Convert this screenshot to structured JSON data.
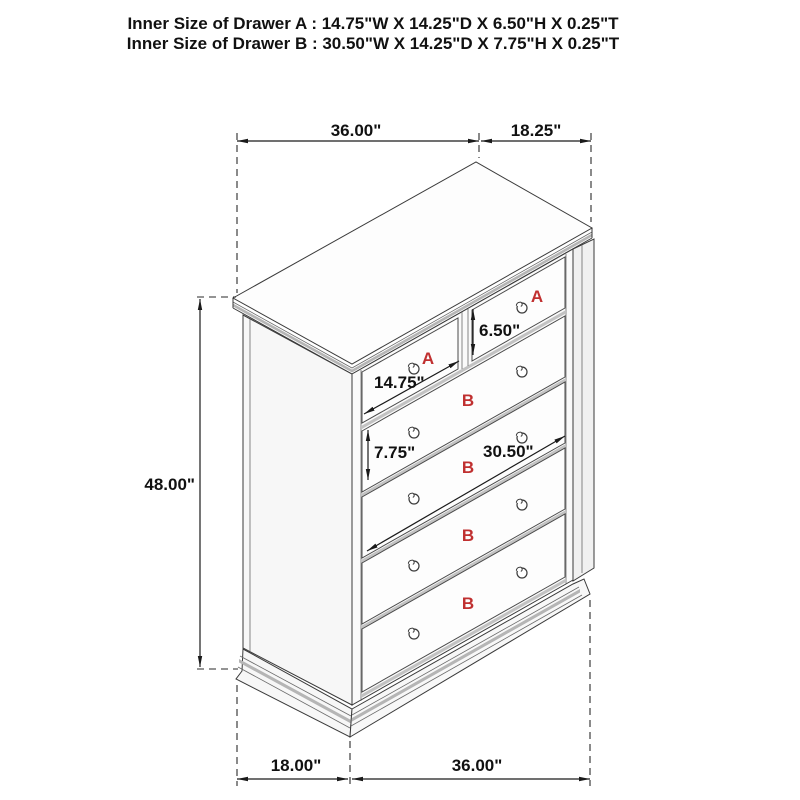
{
  "header": {
    "drawer_a_spec": "Inner Size of Drawer A : 14.75\"W X 14.25\"D X 6.50\"H X 0.25\"T",
    "drawer_b_spec": "Inner Size of Drawer B : 30.50\"W X 14.25\"D X 7.75\"H X 0.25\"T"
  },
  "dimensions": {
    "top_width": "36.00\"",
    "top_depth": "18.25\"",
    "overall_height": "48.00\"",
    "bottom_depth": "18.00\"",
    "bottom_width": "36.00\"",
    "drawer_a_inner_width": "14.75\"",
    "drawer_a_inner_height": "6.50\"",
    "drawer_b_inner_width": "30.50\"",
    "drawer_b_inner_height": "7.75\""
  },
  "labels": {
    "drawer_a": "A",
    "drawer_b": "B"
  },
  "colors": {
    "label_red": "#c03030",
    "dimension_text": "#111111",
    "line_dark": "#3a3a3a",
    "edge_gray": "#b5b5b5"
  }
}
